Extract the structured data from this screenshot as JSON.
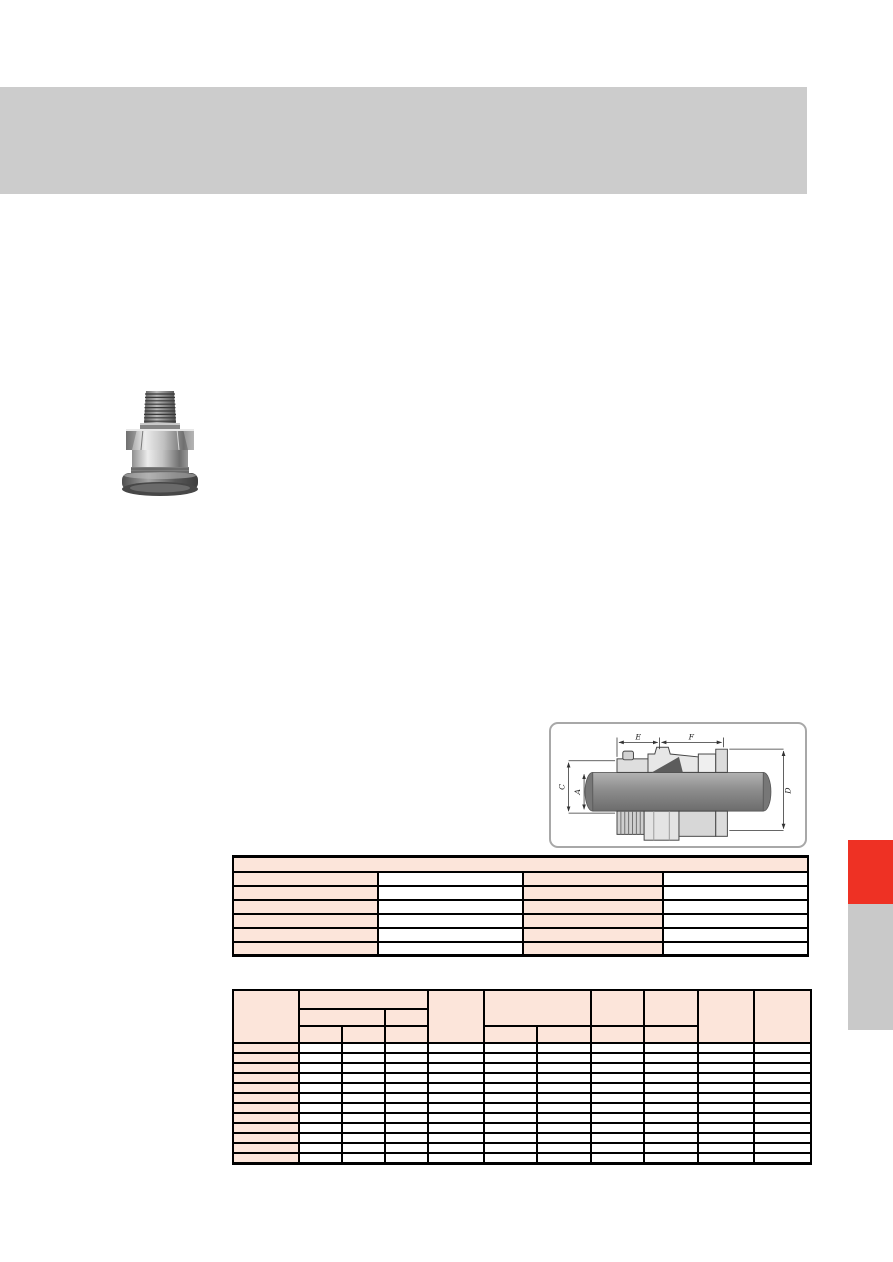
{
  "page": {
    "background": "#ffffff",
    "width": 893,
    "height": 1262
  },
  "header_banner": {
    "color": "#cccccc",
    "text": ""
  },
  "product_photo": {
    "subject": "metal-cable-gland"
  },
  "dimension_diagram": {
    "border_color": "#a8a8a8",
    "labels": {
      "e": "E",
      "f": "F",
      "c": "C",
      "a": "A",
      "d": "D"
    }
  },
  "spec_table": {
    "header_fill": "#fce5da",
    "border_color": "#000000",
    "row_count": 6,
    "col_count": 4,
    "col_widths": [
      145,
      145,
      140,
      145
    ],
    "cell_text": ""
  },
  "dimension_table": {
    "header_fill": "#fce5da",
    "border_color": "#000000",
    "row_count": 12,
    "col_count": 11,
    "col_widths": [
      66,
      43,
      43,
      43,
      56,
      53,
      54,
      53,
      54,
      56,
      57
    ],
    "cell_text": ""
  },
  "side_tabs": {
    "red_tab_color": "#ee3124",
    "gray_tab_color": "#c9c9c9"
  }
}
